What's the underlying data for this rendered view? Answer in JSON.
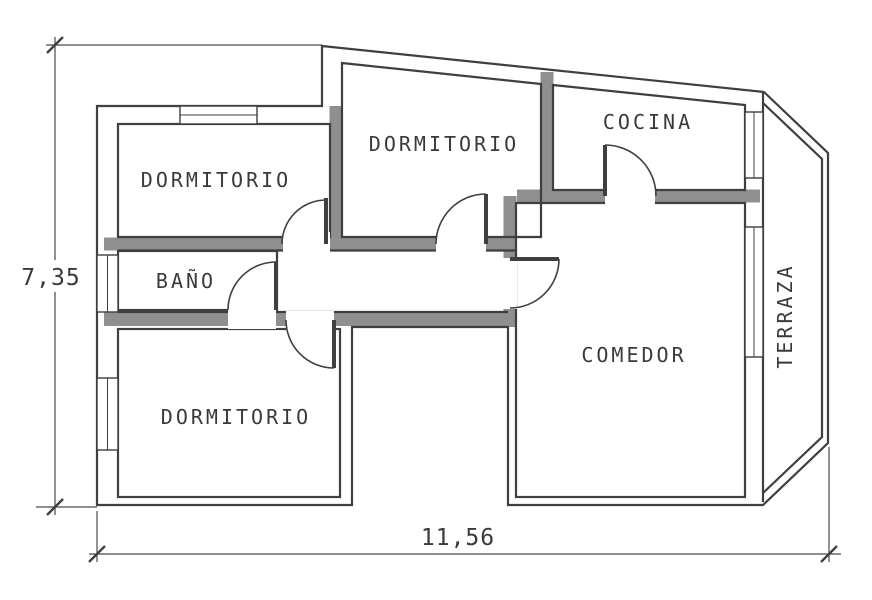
{
  "drawing": {
    "kind": "apartment floor plan",
    "rooms": {
      "dormitorio_top_left": "DORMITORIO",
      "dormitorio_top": "DORMITORIO",
      "cocina": "COCINA",
      "bano": "BAÑO",
      "dormitorio_bottom": "DORMITORIO",
      "comedor": "COMEDOR",
      "terraza": "TERRAZA"
    },
    "dimensions": {
      "height": "7,35",
      "width": "11,56"
    },
    "colors": {
      "line": "#3f3f3f",
      "wall_fill": "#8f8f8f",
      "text": "#3a3a3a",
      "background": "#ffffff"
    }
  }
}
